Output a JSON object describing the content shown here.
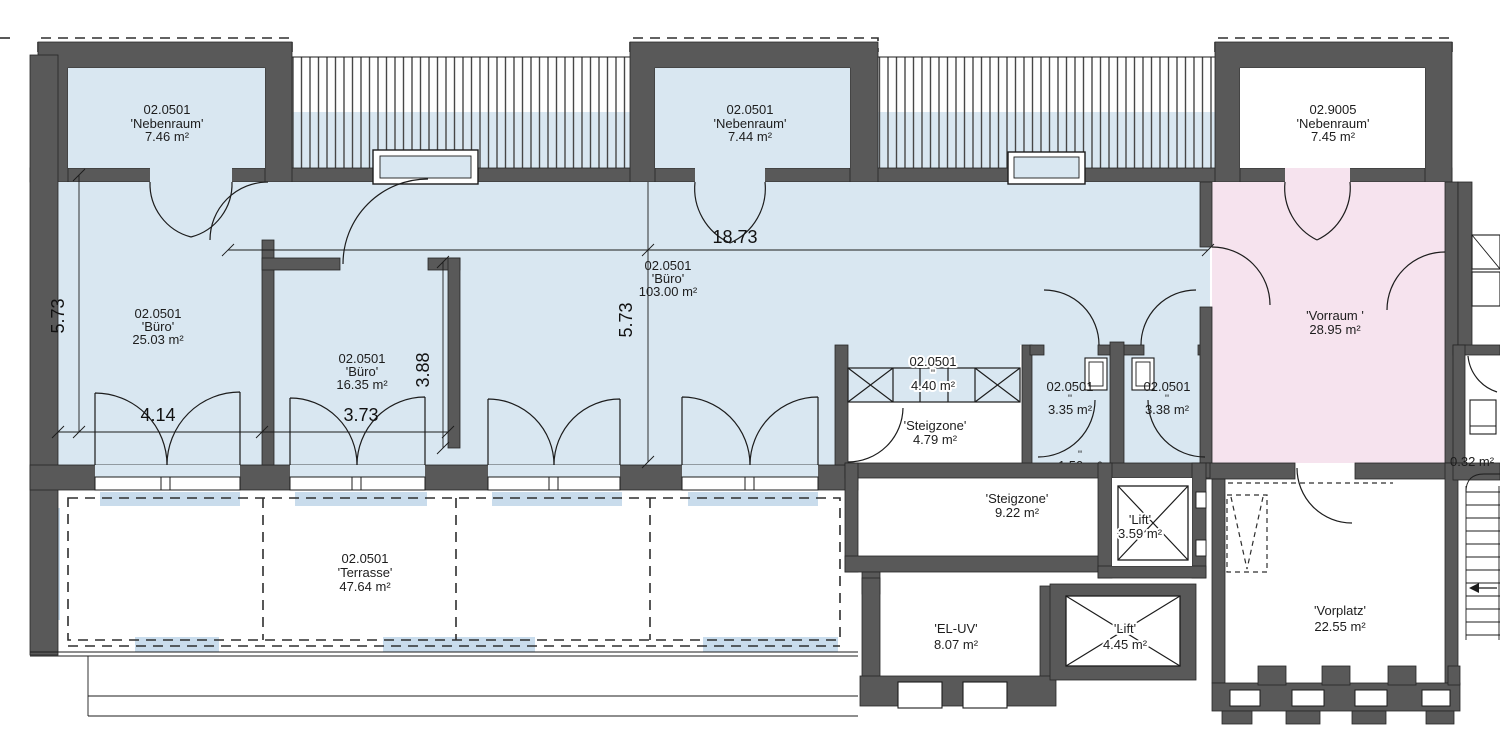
{
  "drawing": {
    "type": "architectural-floor-plan",
    "colors": {
      "wall": "#595959",
      "room_blue": "#d9e7f1",
      "room_pink": "#f6e3ee",
      "room_white": "#ffffff",
      "pad_blue": "#c9dcec",
      "line": "#1c1c1c"
    },
    "rooms": {
      "nebenraum_left": {
        "code": "02.0501",
        "name": "'Nebenraum'",
        "area": "7.46 m²"
      },
      "nebenraum_mid": {
        "code": "02.0501",
        "name": "'Nebenraum'",
        "area": "7.44 m²"
      },
      "nebenraum_right": {
        "code": "02.9005",
        "name": "'Nebenraum'",
        "area": "7.45 m²"
      },
      "buero_left": {
        "code": "02.0501",
        "name": "'Büro'",
        "area": "25.03 m²"
      },
      "buero_small": {
        "code": "02.0501",
        "name": "'Büro'",
        "area": "16.35 m²"
      },
      "buero_large": {
        "code": "02.0501",
        "name": "'Büro'",
        "area": "103.00 m²"
      },
      "zone_440": {
        "code": "02.0501",
        "name": "''",
        "area": "4.40 m²"
      },
      "wc_left": {
        "code": "02.0501",
        "name": "''",
        "area": "3.35 m²"
      },
      "wc_right": {
        "code": "02.0501",
        "name": "''",
        "area": "3.38 m²"
      },
      "wc_lobby": {
        "name": "''",
        "area": "1.50 m²"
      },
      "vorraum": {
        "name": "'Vorraum '",
        "area": "28.95 m²"
      },
      "steigzone_small": {
        "name": "'Steigzone'",
        "area": "4.79 m²"
      },
      "steigzone_large": {
        "name": "'Steigzone'",
        "area": "9.22 m²"
      },
      "lift_small": {
        "name": "'Lift'",
        "area": "3.59 m²"
      },
      "lift_large": {
        "name": "'Lift'",
        "area": "4.45 m²"
      },
      "el_uv": {
        "name": "'EL-UV'",
        "area": "8.07 m²"
      },
      "vorplatz": {
        "name": "'Vorplatz'",
        "area": "22.55 m²"
      },
      "terrasse": {
        "code": "02.0501",
        "name": "'Terrasse'",
        "area": "47.64 m²"
      },
      "niche": {
        "area": "0.32 m²"
      }
    },
    "dimensions": {
      "top_width": "18.73",
      "left_height": "5.73",
      "mid_height": "5.73",
      "room_left_width": "4.14",
      "room_small_width": "3.73",
      "room_small_height": "3.88"
    }
  }
}
